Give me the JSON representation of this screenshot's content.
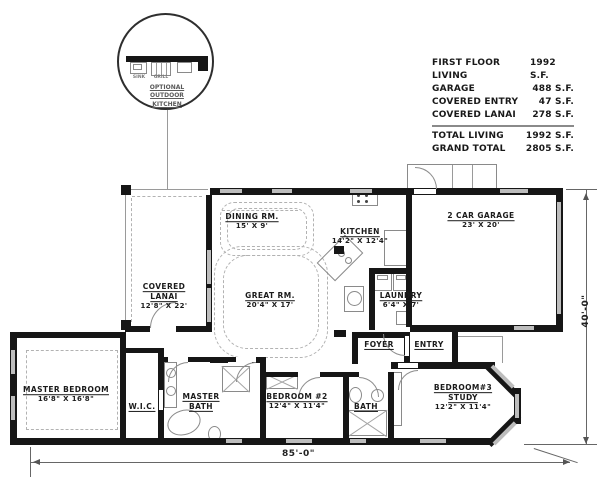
{
  "callout": {
    "label_lines": [
      "OPTIONAL",
      "OUTDOOR",
      "KITCHEN"
    ],
    "sink_label": "SINK",
    "grill_label": "GRILL"
  },
  "area_table": {
    "rows": [
      {
        "label": "FIRST FLOOR LIVING",
        "value": "1992 S.F."
      },
      {
        "label": "GARAGE",
        "value": "488 S.F."
      },
      {
        "label": "COVERED ENTRY",
        "value": "47 S.F."
      },
      {
        "label": "COVERED LANAI",
        "value": "278 S.F."
      }
    ],
    "totals": [
      {
        "label": "TOTAL LIVING",
        "value": "1992 S.F."
      },
      {
        "label": "GRAND TOTAL",
        "value": "2805 S.F."
      }
    ]
  },
  "rooms": {
    "covered_lanai": {
      "name1": "COVERED",
      "name2": "LANAI",
      "dims": "12'8\" X 22'"
    },
    "dining": {
      "name1": "DINING RM.",
      "dims": "15' X 9'"
    },
    "kitchen": {
      "name1": "KITCHEN",
      "dims": "14'2\" X 12'4\""
    },
    "garage": {
      "name1": "2 CAR GARAGE",
      "dims": "23' X 20'"
    },
    "great_room": {
      "name1": "GREAT RM.",
      "dims": "20'4\" X 17'"
    },
    "laundry": {
      "name1": "LAUNDRY",
      "dims": "6'4\" X 7'"
    },
    "foyer": {
      "name1": "FOYER"
    },
    "entry": {
      "name1": "ENTRY"
    },
    "master_bedroom": {
      "name1": "MASTER BEDROOM",
      "dims": "16'8\" X 16'8\""
    },
    "wic": {
      "name1": "W.I.C."
    },
    "master_bath": {
      "name1": "MASTER",
      "name2": "BATH"
    },
    "bedroom2": {
      "name1": "BEDROOM #2",
      "dims": "12'4\" X 11'4\""
    },
    "bath": {
      "name1": "BATH"
    },
    "bedroom3": {
      "name1": "BEDROOM#3",
      "name2": "STUDY",
      "dims": "12'2\" X 11'4\""
    }
  },
  "dimensions": {
    "width": "85'-0\"",
    "height": "40'-0\""
  }
}
